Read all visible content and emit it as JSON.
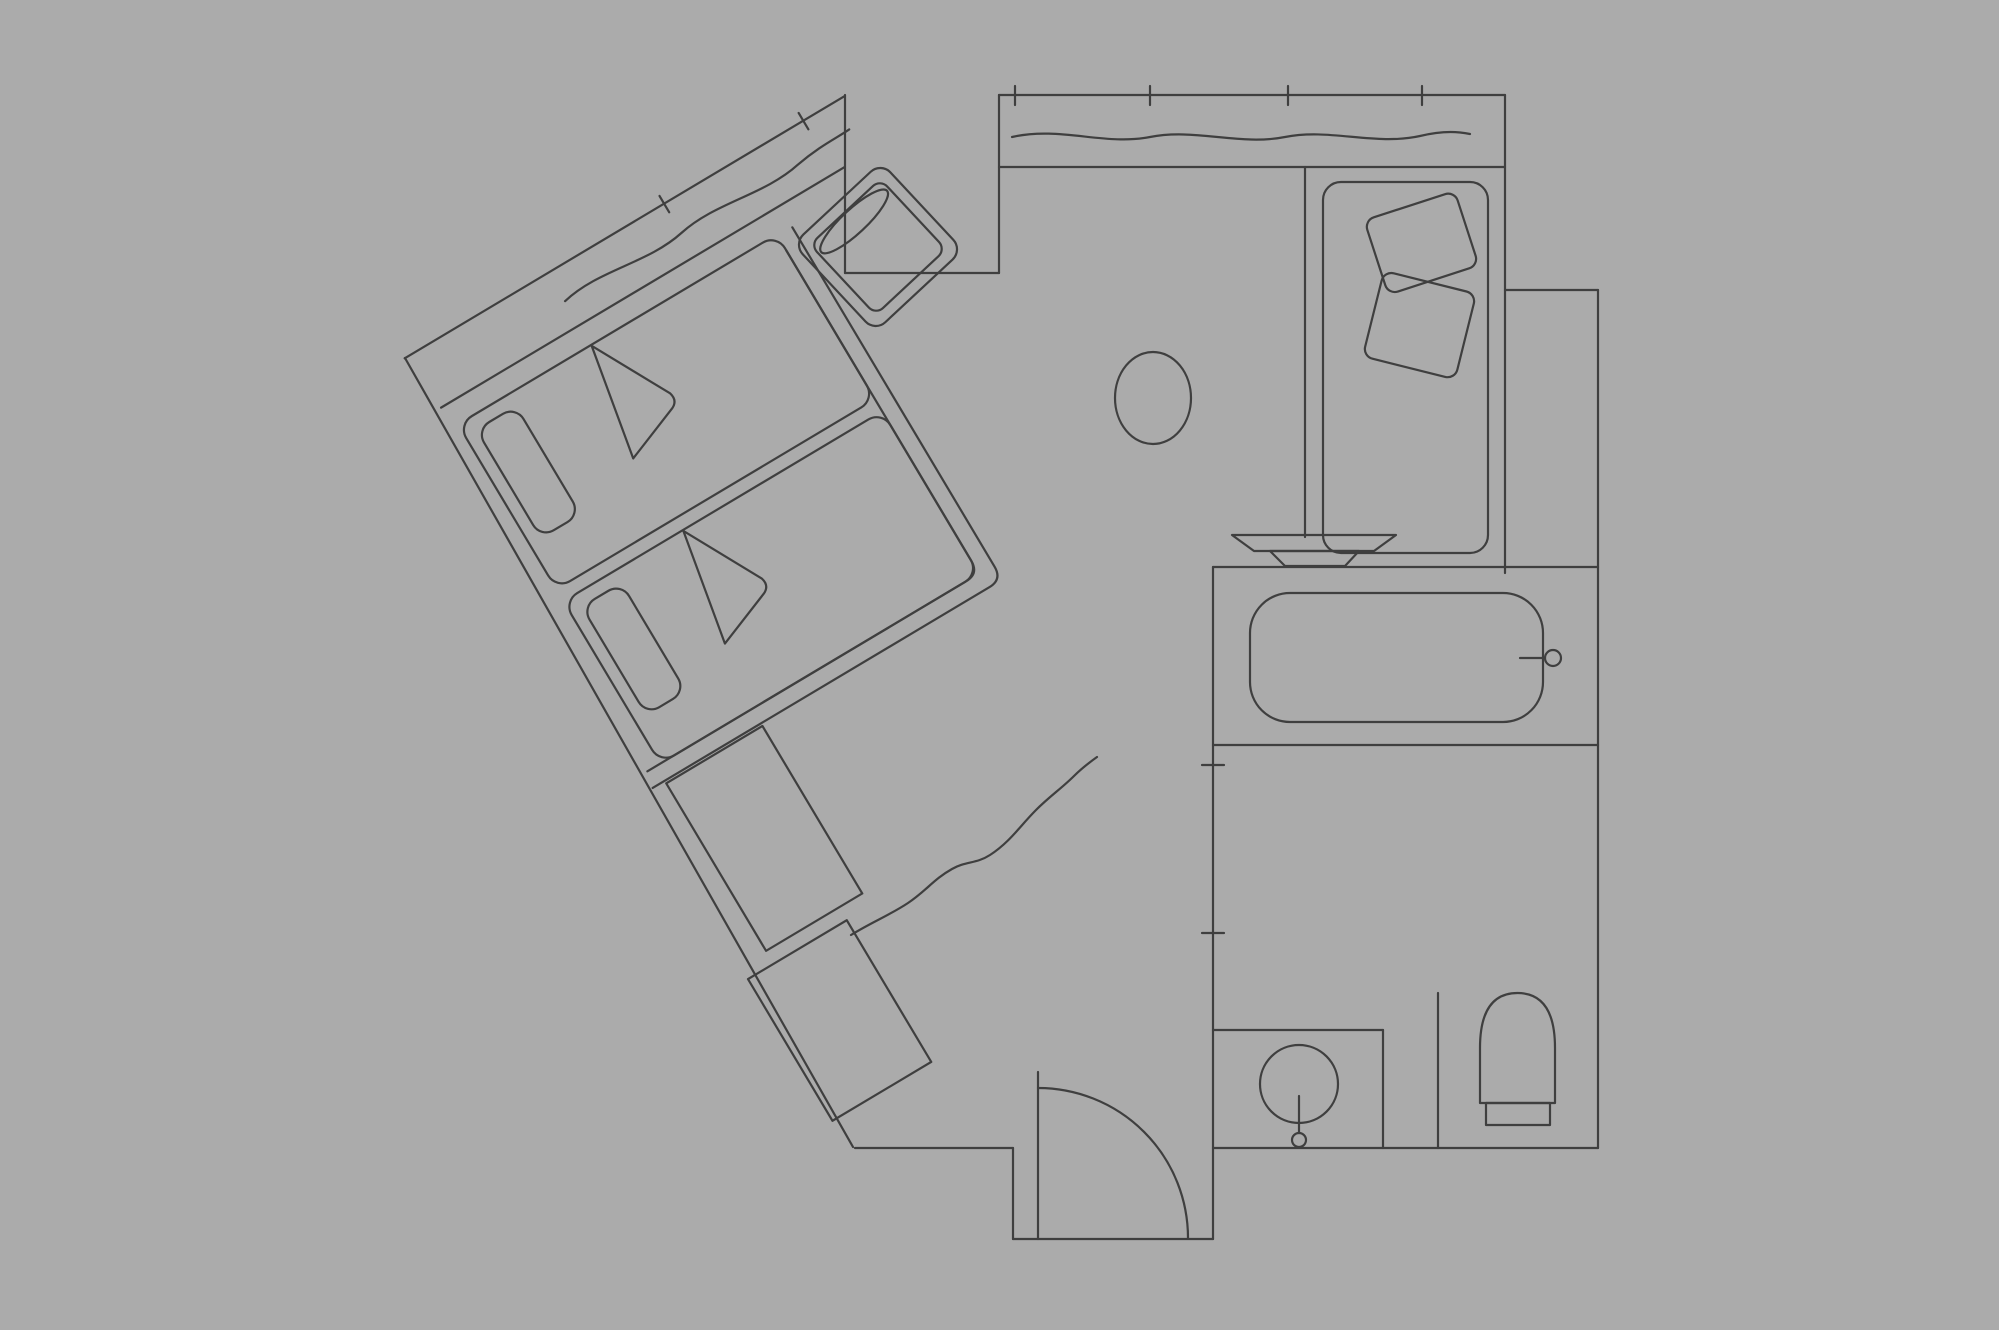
{
  "document": {
    "kind": "floor-plan",
    "subject": "hotel-guest-room-plan"
  },
  "canvas": {
    "width": 1999,
    "height": 1330,
    "background": "#ababab",
    "line_color": "#3f3f3f",
    "line_width": 2.2
  },
  "fixtures": [
    "bed-1",
    "bed-2",
    "pillow",
    "blanket-fold",
    "nightstand-desk",
    "luggage-bench",
    "armchair",
    "seat-cushion",
    "side-table",
    "chaise-longue",
    "chaise-cushion",
    "washbasin-dish",
    "bathtub",
    "bath-faucet",
    "vanity-counter",
    "vanity-basin",
    "basin-faucet",
    "toilet",
    "entry-door",
    "door-swing-arc",
    "window-wall",
    "curtain-wave",
    "wall-tick-mark"
  ],
  "elements": [
    {
      "name": "wing-group",
      "type": "group",
      "transform": "rotate(-30.8 845 97)",
      "children": [
        {
          "name": "wing-window-outer-wall",
          "type": "line",
          "x1": 333,
          "y1": 96,
          "x2": 845,
          "y2": 96
        },
        {
          "name": "wing-window-sill",
          "type": "line",
          "x1": 339,
          "y1": 157,
          "x2": 809,
          "y2": 157
        },
        {
          "name": "wing-curtain-wave",
          "type": "path",
          "d": "M 500,129 C 545,119 590,139 635,130 C 680,121 725,140 770,131 C 798,126 818,128 832,127"
        },
        {
          "name": "wing-window-tick-1",
          "type": "line",
          "x1": 635,
          "y1": 87,
          "x2": 635,
          "y2": 106
        },
        {
          "name": "wing-window-tick-2",
          "type": "line",
          "x1": 797,
          "y1": 87,
          "x2": 797,
          "y2": 106
        },
        {
          "name": "bed-1",
          "type": "rect",
          "x": 345,
          "y": 180,
          "w": 371,
          "h": 192,
          "rx": 16
        },
        {
          "name": "bed-1-pillow",
          "type": "rect",
          "x": 358,
          "y": 194,
          "w": 46,
          "h": 126,
          "rx": 15
        },
        {
          "name": "bed-1-fold",
          "type": "path",
          "d": "M 500,181 L 543,262 Q 546,272 537,276 L 478,299 Z"
        },
        {
          "name": "bed-2",
          "type": "rect",
          "x": 345,
          "y": 386,
          "w": 371,
          "h": 189,
          "rx": 16
        },
        {
          "name": "bed-2-pillow",
          "type": "rect",
          "x": 358,
          "y": 400,
          "w": 46,
          "h": 126,
          "rx": 15
        },
        {
          "name": "bed-2-fold",
          "type": "path",
          "d": "M 484,387 L 527,468 Q 530,478 521,482 L 462,505 Z"
        },
        {
          "name": "bedroom-partition-outer",
          "type": "path",
          "d": "M 733,182 L 733,577 Q 733,592 718,592 L 326,592"
        },
        {
          "name": "bedroom-partition-inner",
          "type": "path",
          "d": "M 716,199 L 716,560 Q 716,575 701,575 L 330,575"
        },
        {
          "name": "nightstand-desk",
          "type": "rect",
          "x": 340,
          "y": 595,
          "w": 112,
          "h": 195
        },
        {
          "name": "luggage-bench",
          "type": "rect",
          "x": 310,
          "y": 805,
          "w": 115,
          "h": 165
        }
      ]
    },
    {
      "name": "wing-sw-outer-wall",
      "type": "line",
      "x1": 405,
      "y1": 358,
      "x2": 853,
      "y2": 1147
    },
    {
      "name": "wing-tip-jamb",
      "type": "line",
      "x1": 845,
      "y1": 95,
      "x2": 845,
      "y2": 273
    },
    {
      "name": "notch-bottom-wall",
      "type": "line",
      "x1": 845,
      "y1": 273,
      "x2": 999,
      "y2": 273
    },
    {
      "name": "window-left-jamb",
      "type": "line",
      "x1": 999,
      "y1": 95,
      "x2": 999,
      "y2": 273
    },
    {
      "name": "top-window-outer-wall",
      "type": "line",
      "x1": 999,
      "y1": 95,
      "x2": 1505,
      "y2": 95
    },
    {
      "name": "top-window-sill",
      "type": "line",
      "x1": 999,
      "y1": 167,
      "x2": 1505,
      "y2": 167
    },
    {
      "name": "top-curtain-wave",
      "type": "path",
      "d": "M 1012,137 C 1060,126 1105,146 1150,137 C 1195,128 1240,146 1285,137 C 1330,128 1375,146 1420,136 C 1445,130 1460,132 1470,134"
    },
    {
      "name": "top-window-tick-1",
      "type": "line",
      "x1": 1015,
      "y1": 86,
      "x2": 1015,
      "y2": 105
    },
    {
      "name": "top-window-tick-2",
      "type": "line",
      "x1": 1150,
      "y1": 86,
      "x2": 1150,
      "y2": 105
    },
    {
      "name": "top-window-tick-3",
      "type": "line",
      "x1": 1288,
      "y1": 86,
      "x2": 1288,
      "y2": 105
    },
    {
      "name": "top-window-tick-4",
      "type": "line",
      "x1": 1422,
      "y1": 86,
      "x2": 1422,
      "y2": 105
    },
    {
      "name": "right-wall-upper",
      "type": "line",
      "x1": 1505,
      "y1": 95,
      "x2": 1505,
      "y2": 573
    },
    {
      "name": "right-step-wall",
      "type": "line",
      "x1": 1505,
      "y1": 290,
      "x2": 1598,
      "y2": 290
    },
    {
      "name": "right-outer-wall",
      "type": "line",
      "x1": 1598,
      "y1": 290,
      "x2": 1598,
      "y2": 1148
    },
    {
      "name": "chaise-room-wall",
      "type": "line",
      "x1": 1305,
      "y1": 167,
      "x2": 1305,
      "y2": 537
    },
    {
      "name": "chaise-longue",
      "type": "rect",
      "x": 1323,
      "y": 182,
      "w": 165,
      "h": 371,
      "rx": 18
    },
    {
      "name": "chaise-cushion-1",
      "type": "rect",
      "x": 1374,
      "y": 204,
      "w": 95,
      "h": 78,
      "rx": 10,
      "transform": "rotate(-18 1421 243)"
    },
    {
      "name": "chaise-cushion-2",
      "type": "rect",
      "x": 1372,
      "y": 281,
      "w": 95,
      "h": 88,
      "rx": 10,
      "transform": "rotate(14 1419 325)"
    },
    {
      "name": "washbasin-dish-top",
      "type": "path",
      "d": "M 1232,535 L 1396,535 L 1374,551 L 1254,551 Z"
    },
    {
      "name": "washbasin-dish-bowl",
      "type": "path",
      "d": "M 1270,551 L 1359,551 L 1345,566 L 1285,566 Z"
    },
    {
      "name": "bath-room-top-wall",
      "type": "line",
      "x1": 1213,
      "y1": 567,
      "x2": 1598,
      "y2": 567
    },
    {
      "name": "bath-room-left-wall",
      "type": "line",
      "x1": 1213,
      "y1": 567,
      "x2": 1213,
      "y2": 1239
    },
    {
      "name": "bath-wall-tick-1",
      "type": "line",
      "x1": 1202,
      "y1": 765,
      "x2": 1224,
      "y2": 765
    },
    {
      "name": "bath-wall-tick-2",
      "type": "line",
      "x1": 1202,
      "y1": 933,
      "x2": 1224,
      "y2": 933
    },
    {
      "name": "bathtub",
      "type": "rect",
      "x": 1250,
      "y": 593,
      "w": 293,
      "h": 129,
      "rx": 40
    },
    {
      "name": "bath-faucet-stem",
      "type": "line",
      "x1": 1520,
      "y1": 658,
      "x2": 1545,
      "y2": 658
    },
    {
      "name": "bath-faucet-knob",
      "type": "circle",
      "cx": 1553,
      "cy": 658,
      "r": 8
    },
    {
      "name": "bath-wc-divider-wall",
      "type": "line",
      "x1": 1213,
      "y1": 745,
      "x2": 1598,
      "y2": 745
    },
    {
      "name": "vanity-counter-top",
      "type": "line",
      "x1": 1213,
      "y1": 1030,
      "x2": 1383,
      "y2": 1030
    },
    {
      "name": "vanity-counter-side",
      "type": "line",
      "x1": 1383,
      "y1": 1030,
      "x2": 1383,
      "y2": 1148
    },
    {
      "name": "vanity-basin",
      "type": "circle",
      "cx": 1299,
      "cy": 1084,
      "r": 39
    },
    {
      "name": "basin-faucet-stem",
      "type": "line",
      "x1": 1299,
      "y1": 1096,
      "x2": 1299,
      "y2": 1133
    },
    {
      "name": "basin-faucet-knob",
      "type": "circle",
      "cx": 1299,
      "cy": 1140,
      "r": 7
    },
    {
      "name": "wc-partition-wall",
      "type": "line",
      "x1": 1438,
      "y1": 993,
      "x2": 1438,
      "y2": 1148
    },
    {
      "name": "toilet-bowl",
      "type": "path",
      "d": "M 1480,1103 L 1480,1048 Q 1480,993 1517.5,993 Q 1555,993 1555,1048 L 1555,1103 Z"
    },
    {
      "name": "toilet-tank",
      "type": "rect",
      "x": 1486,
      "y": 1103,
      "w": 64,
      "h": 22
    },
    {
      "name": "bottom-right-wall",
      "type": "line",
      "x1": 1213,
      "y1": 1148,
      "x2": 1598,
      "y2": 1148
    },
    {
      "name": "bottom-main-wall",
      "type": "line",
      "x1": 855,
      "y1": 1148,
      "x2": 1013,
      "y2": 1148
    },
    {
      "name": "vestibule-left-wall",
      "type": "line",
      "x1": 1013,
      "y1": 1148,
      "x2": 1013,
      "y2": 1239
    },
    {
      "name": "vestibule-bottom-wall",
      "type": "line",
      "x1": 1013,
      "y1": 1239,
      "x2": 1213,
      "y2": 1239
    },
    {
      "name": "entry-door-leaf",
      "type": "line",
      "x1": 1038,
      "y1": 1072,
      "x2": 1038,
      "y2": 1239
    },
    {
      "name": "door-swing-arc",
      "type": "path",
      "d": "M 1038,1088 A 150,150 0 0 1 1188,1238"
    },
    {
      "name": "corridor-curtain-wave",
      "type": "path",
      "d": "M 851,935 C 872,922 890,915 908,903 C 926,891 934,879 952,869 C 966,861 976,864 990,855 C 1010,842 1020,826 1036,810 C 1050,796 1062,788 1074,776 C 1082,768 1090,762 1097,757"
    },
    {
      "name": "armchair-group",
      "type": "group",
      "transform": "rotate(-43 878 247)",
      "children": [
        {
          "name": "armchair-outer",
          "type": "rect",
          "x": 818,
          "y": 187,
          "w": 120,
          "h": 120,
          "rx": 14
        },
        {
          "name": "armchair-seat",
          "type": "rect",
          "x": 830,
          "y": 199,
          "w": 96,
          "h": 96,
          "rx": 10
        },
        {
          "name": "armchair-cushion",
          "type": "ellipse",
          "cx": 878,
          "cy": 212,
          "rx": 45,
          "ry": 12
        }
      ]
    },
    {
      "name": "side-table",
      "type": "ellipse",
      "cx": 1153,
      "cy": 398,
      "rx": 38,
      "ry": 46
    }
  ]
}
